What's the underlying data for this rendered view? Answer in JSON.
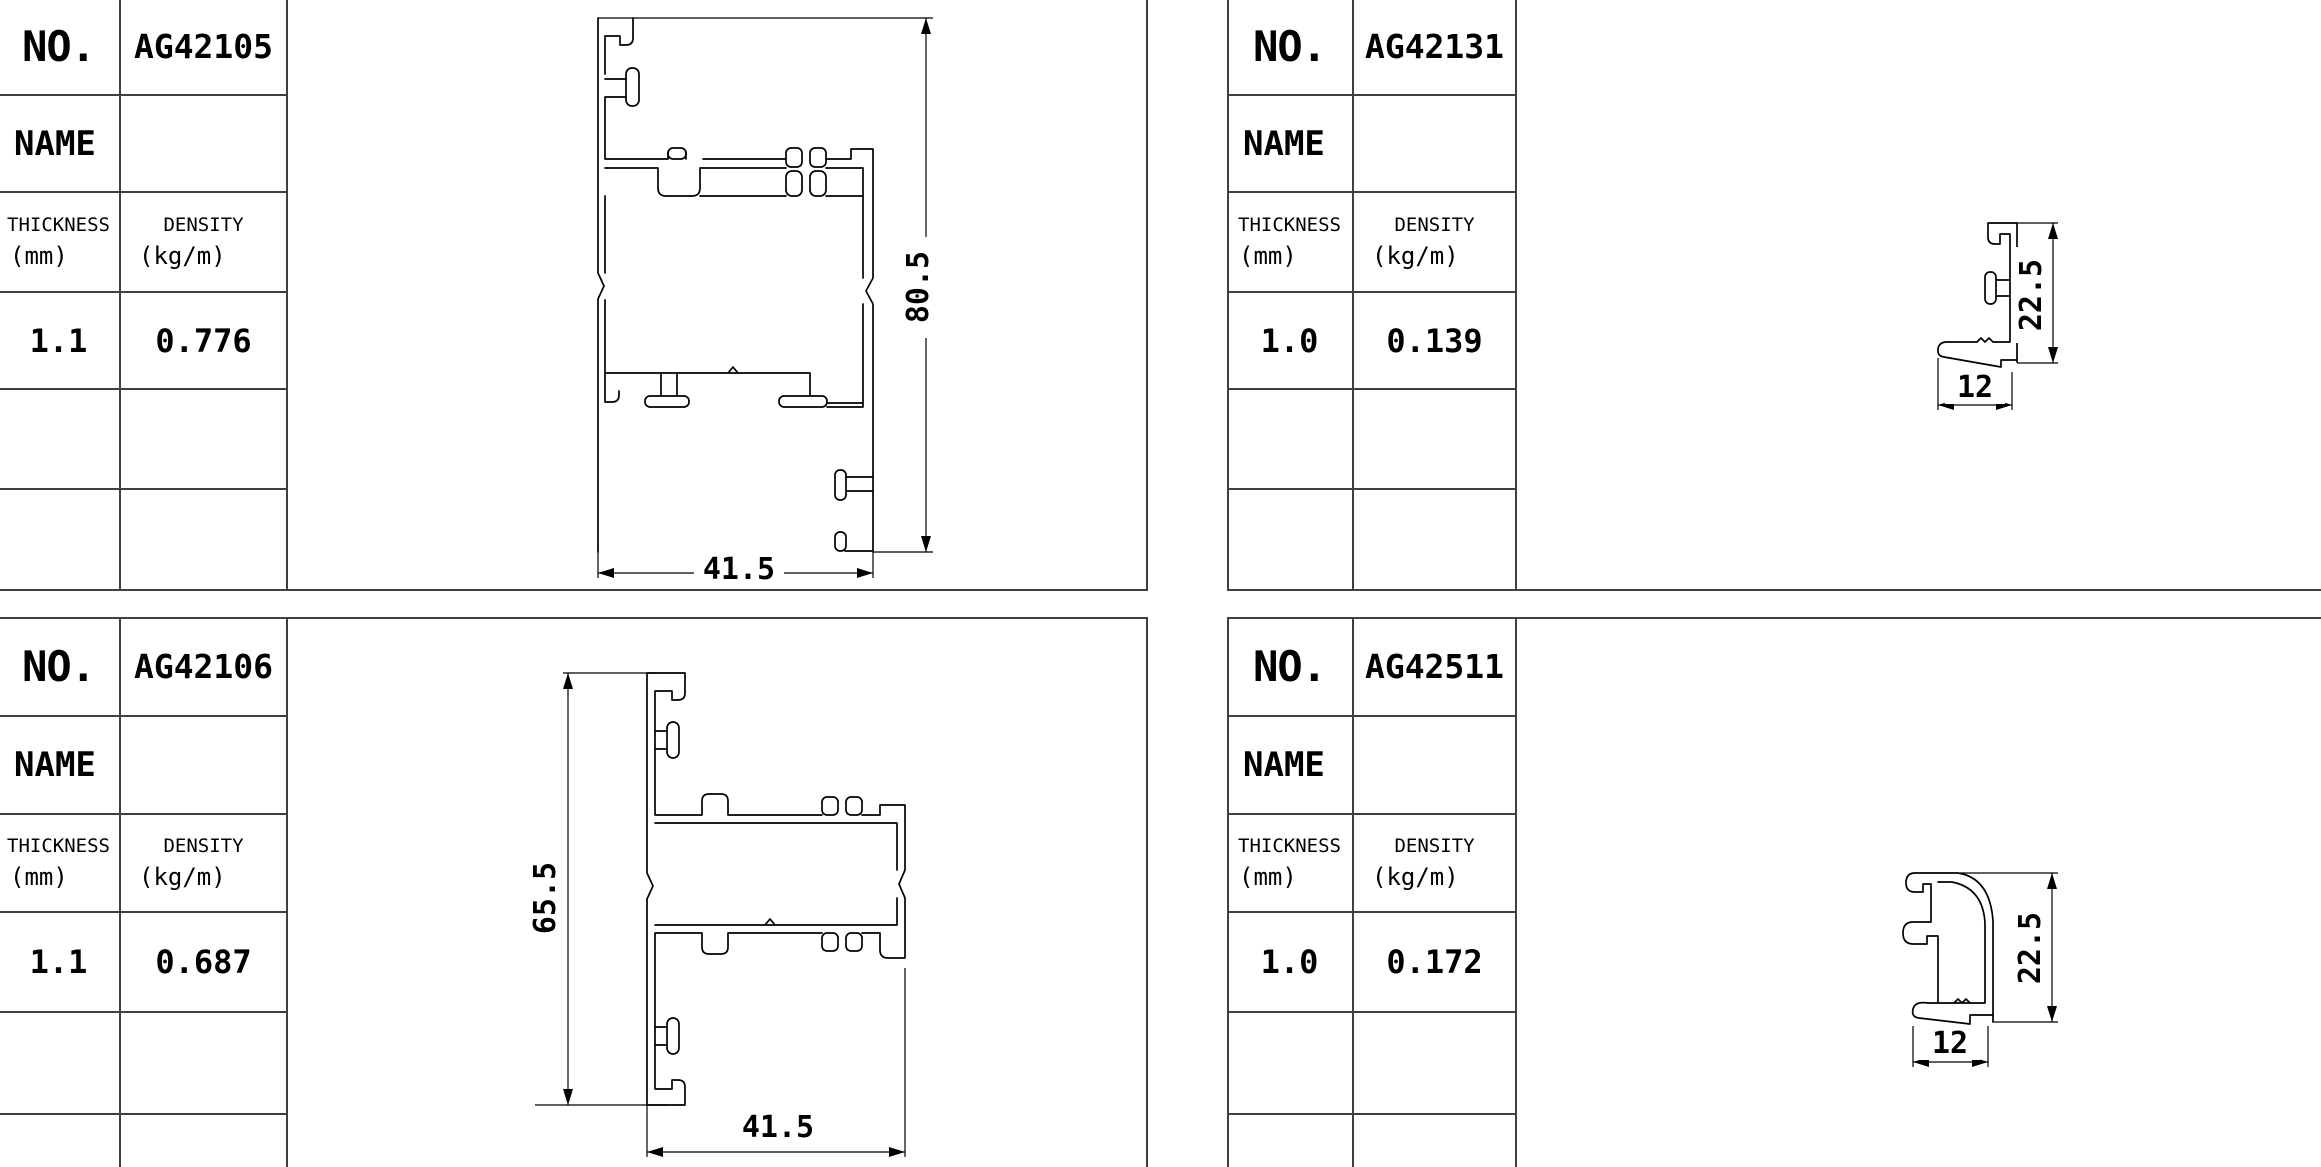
{
  "page": {
    "background": "#ffffff",
    "drawing_line_color": "#000000",
    "table_grid_color": "#3f3f3f",
    "text_color": "#000000"
  },
  "labels": {
    "no": "NO.",
    "name": "NAME",
    "thickness_line1": "THICKNESS",
    "thickness_line2": "(mm)",
    "density_line1": "DENSITY",
    "density_line2": "(kg/m)"
  },
  "panels": [
    {
      "code": "AG42105",
      "name_value": "",
      "thickness": "1.1",
      "density": "0.776",
      "dim_width": "41.5",
      "dim_height": "80.5"
    },
    {
      "code": "AG42131",
      "name_value": "",
      "thickness": "1.0",
      "density": "0.139",
      "dim_width": "12",
      "dim_height": "22.5"
    },
    {
      "code": "AG42106",
      "name_value": "",
      "thickness": "1.1",
      "density": "0.687",
      "dim_width": "41.5",
      "dim_height": "65.5"
    },
    {
      "code": "AG42511",
      "name_value": "",
      "thickness": "1.0",
      "density": "0.172",
      "dim_width": "12",
      "dim_height": "22.5"
    }
  ]
}
